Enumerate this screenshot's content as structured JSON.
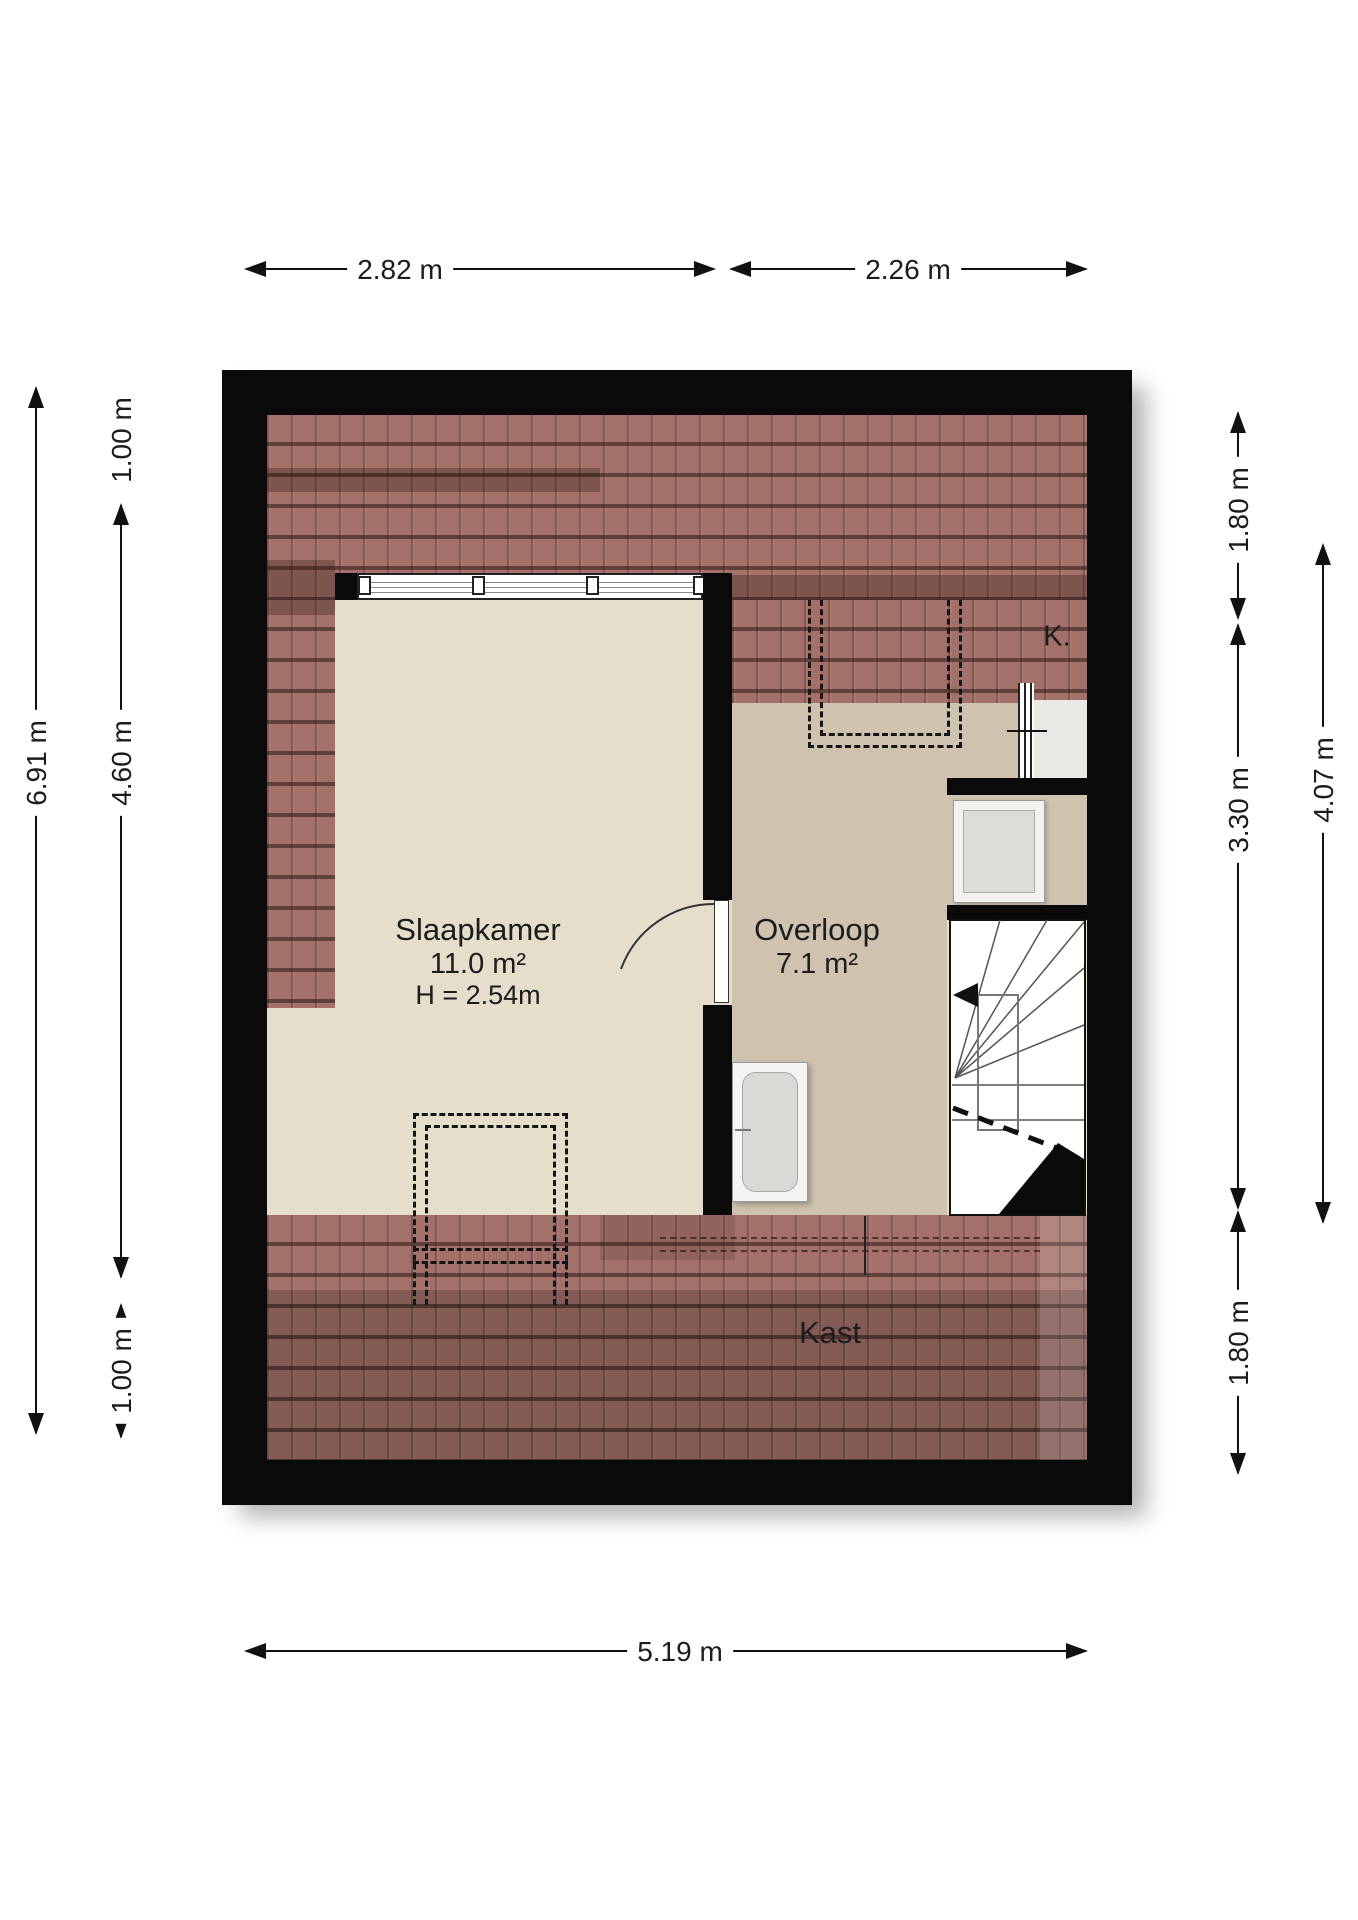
{
  "rooms": {
    "slaapkamer": {
      "name": "Slaapkamer",
      "area": "11.0 m²",
      "height": "H = 2.54m"
    },
    "overloop": {
      "name": "Overloop",
      "area": "7.1 m²"
    },
    "kast": {
      "name": "Kast"
    },
    "k": {
      "name": "K."
    }
  },
  "dimensions": {
    "top": [
      "2.82 m",
      "2.26 m"
    ],
    "bottom": [
      "5.19 m"
    ],
    "left": [
      "6.91 m",
      "1.00 m",
      "4.60 m",
      "1.00 m"
    ],
    "right": [
      "1.80 m",
      "3.30 m",
      "1.80 m",
      "4.07 m"
    ]
  },
  "colors": {
    "wall": "#0a0a0a",
    "roof_tiles": "#a4716a",
    "bedroom_floor": "#e4decb",
    "landing_floor": "#cfc3af",
    "dimension_line": "#111111"
  }
}
